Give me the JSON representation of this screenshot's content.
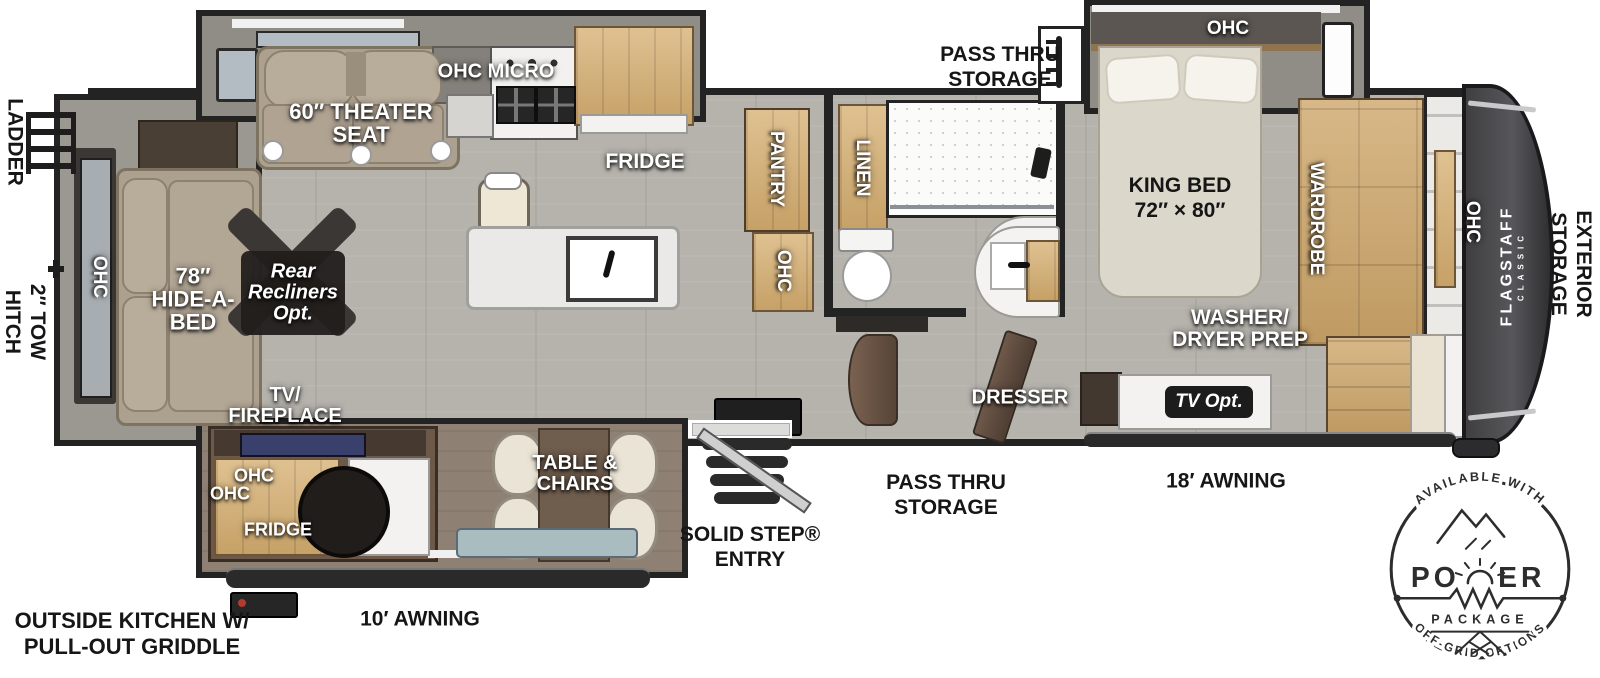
{
  "exterior": {
    "ladder": "LADDER",
    "tow_hitch": [
      "2″ TOW",
      "HITCH"
    ],
    "pass_thru_top": [
      "PASS THRU",
      "STORAGE"
    ],
    "pass_thru_bottom": [
      "PASS THRU",
      "STORAGE"
    ],
    "awning_front": "18′ AWNING",
    "awning_rear": "10′ AWNING",
    "entry": [
      "SOLID STEP®",
      "ENTRY"
    ],
    "outside_kitchen": [
      "OUTSIDE KITCHEN W/",
      "PULL-OUT GRIDDLE"
    ],
    "exterior_storage": [
      "EXTERIOR",
      "STORAGE"
    ],
    "brand": "FLAGSTAFF",
    "brand_sub": "CLASSIC"
  },
  "living": {
    "rear_ohc": "OHC",
    "hide_a_bed": [
      "78″",
      "HIDE-A-",
      "BED"
    ],
    "recliners": [
      "Rear",
      "Recliners",
      "Opt."
    ],
    "theater_seat": [
      "60″ THEATER",
      "SEAT"
    ],
    "tv_fireplace": [
      "TV/",
      "FIREPLACE"
    ],
    "table_chairs": [
      "TABLE &",
      "CHAIRS"
    ]
  },
  "kitchen": {
    "ohc_micro": "OHC MICRO",
    "fridge": "FRIDGE",
    "pantry": "PANTRY",
    "pantry_ohc": "OHC"
  },
  "bath": {
    "linen": "LINEN"
  },
  "bedroom": {
    "ohc": "OHC",
    "king_bed": [
      "KING BED",
      "72″ × 80″"
    ],
    "wardrobe": "WARDROBE",
    "washer_dryer": [
      "WASHER/",
      "DRYER PREP"
    ],
    "dresser": "DRESSER",
    "tv_opt": "TV Opt.",
    "front_ohc": "OHC"
  },
  "outside_kitchen_unit": {
    "ohc1": "OHC",
    "ohc2": "OHC",
    "fridge": "FRIDGE"
  },
  "power_badge": {
    "top_arc": "AVAILABLE WITH",
    "name_left": "PO",
    "name_right": "ER",
    "package": "PACKAGE",
    "bottom_arc": "OFF-GRID OPTIONS"
  },
  "colors": {
    "wall": "#232323",
    "floor": "#b6b3ad",
    "wood": "#d3b582",
    "front_cap": "#4a4a4c",
    "badge_ink": "#2d2d2d"
  }
}
